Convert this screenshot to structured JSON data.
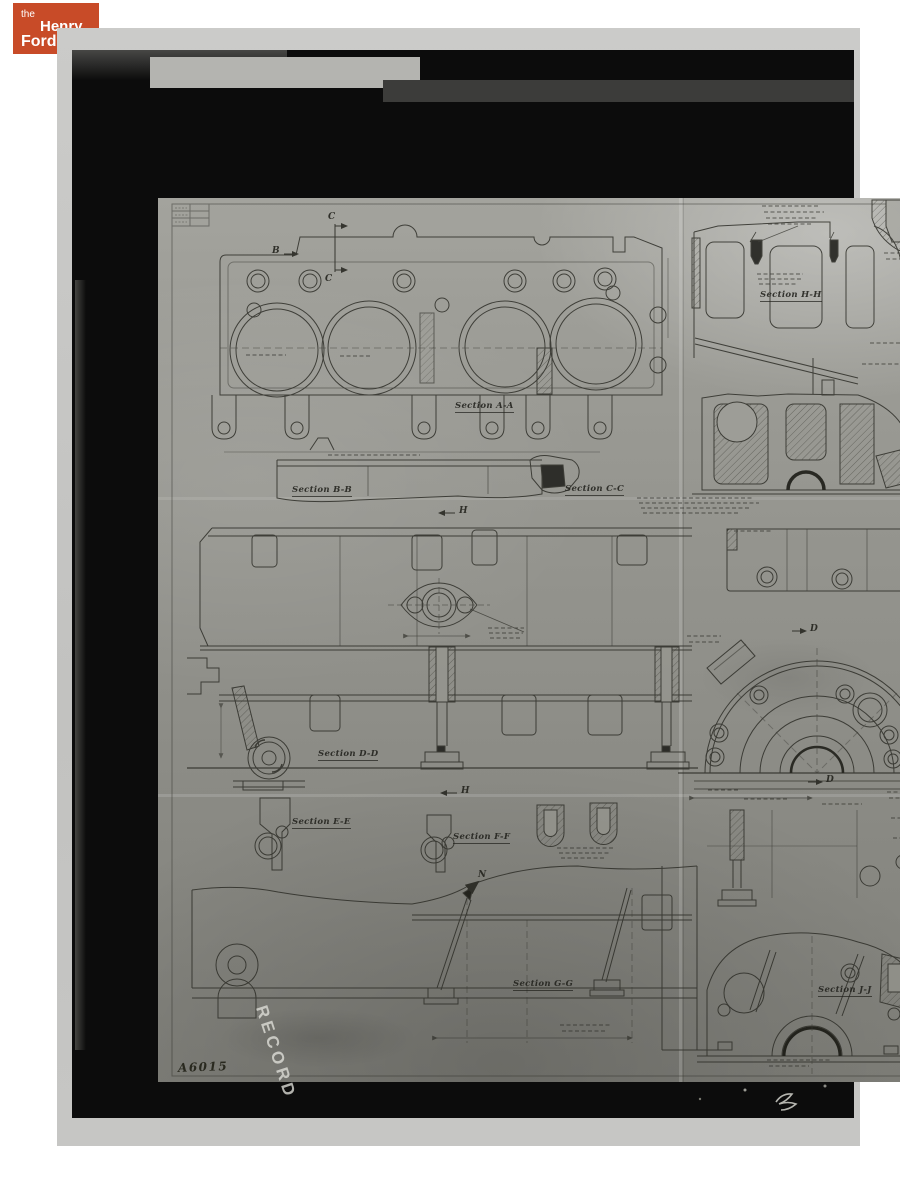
{
  "header_logo": {
    "the": "the",
    "henry": "Henry",
    "ford": "Ford"
  },
  "photo": {
    "watermark": "RECORD",
    "drawing_number": "A6015",
    "subject": "engine cylinder block engineering drawing"
  },
  "sections": [
    {
      "label": "Section A-A"
    },
    {
      "label": "Section B-B"
    },
    {
      "label": "Section C-C"
    },
    {
      "label": "Section D-D"
    },
    {
      "label": "Section E-E"
    },
    {
      "label": "Section F-F"
    },
    {
      "label": "Section G-G"
    },
    {
      "label": "Section H-H"
    },
    {
      "label": "Section J-J"
    }
  ],
  "callouts": [
    {
      "label": "C"
    },
    {
      "label": "C"
    },
    {
      "label": "B"
    },
    {
      "label": "H"
    },
    {
      "label": "H"
    },
    {
      "label": "D"
    },
    {
      "label": "D"
    },
    {
      "label": "N"
    }
  ],
  "colors": {
    "logo_bg": "#c84b28",
    "logo_text": "#ffffff",
    "scan_margin": "#c5c5c3",
    "film_black": "#0c0c0c",
    "paper_gray": "#95958f",
    "ink": "#2e2e28",
    "watermark_gray": "#e0e0da"
  }
}
